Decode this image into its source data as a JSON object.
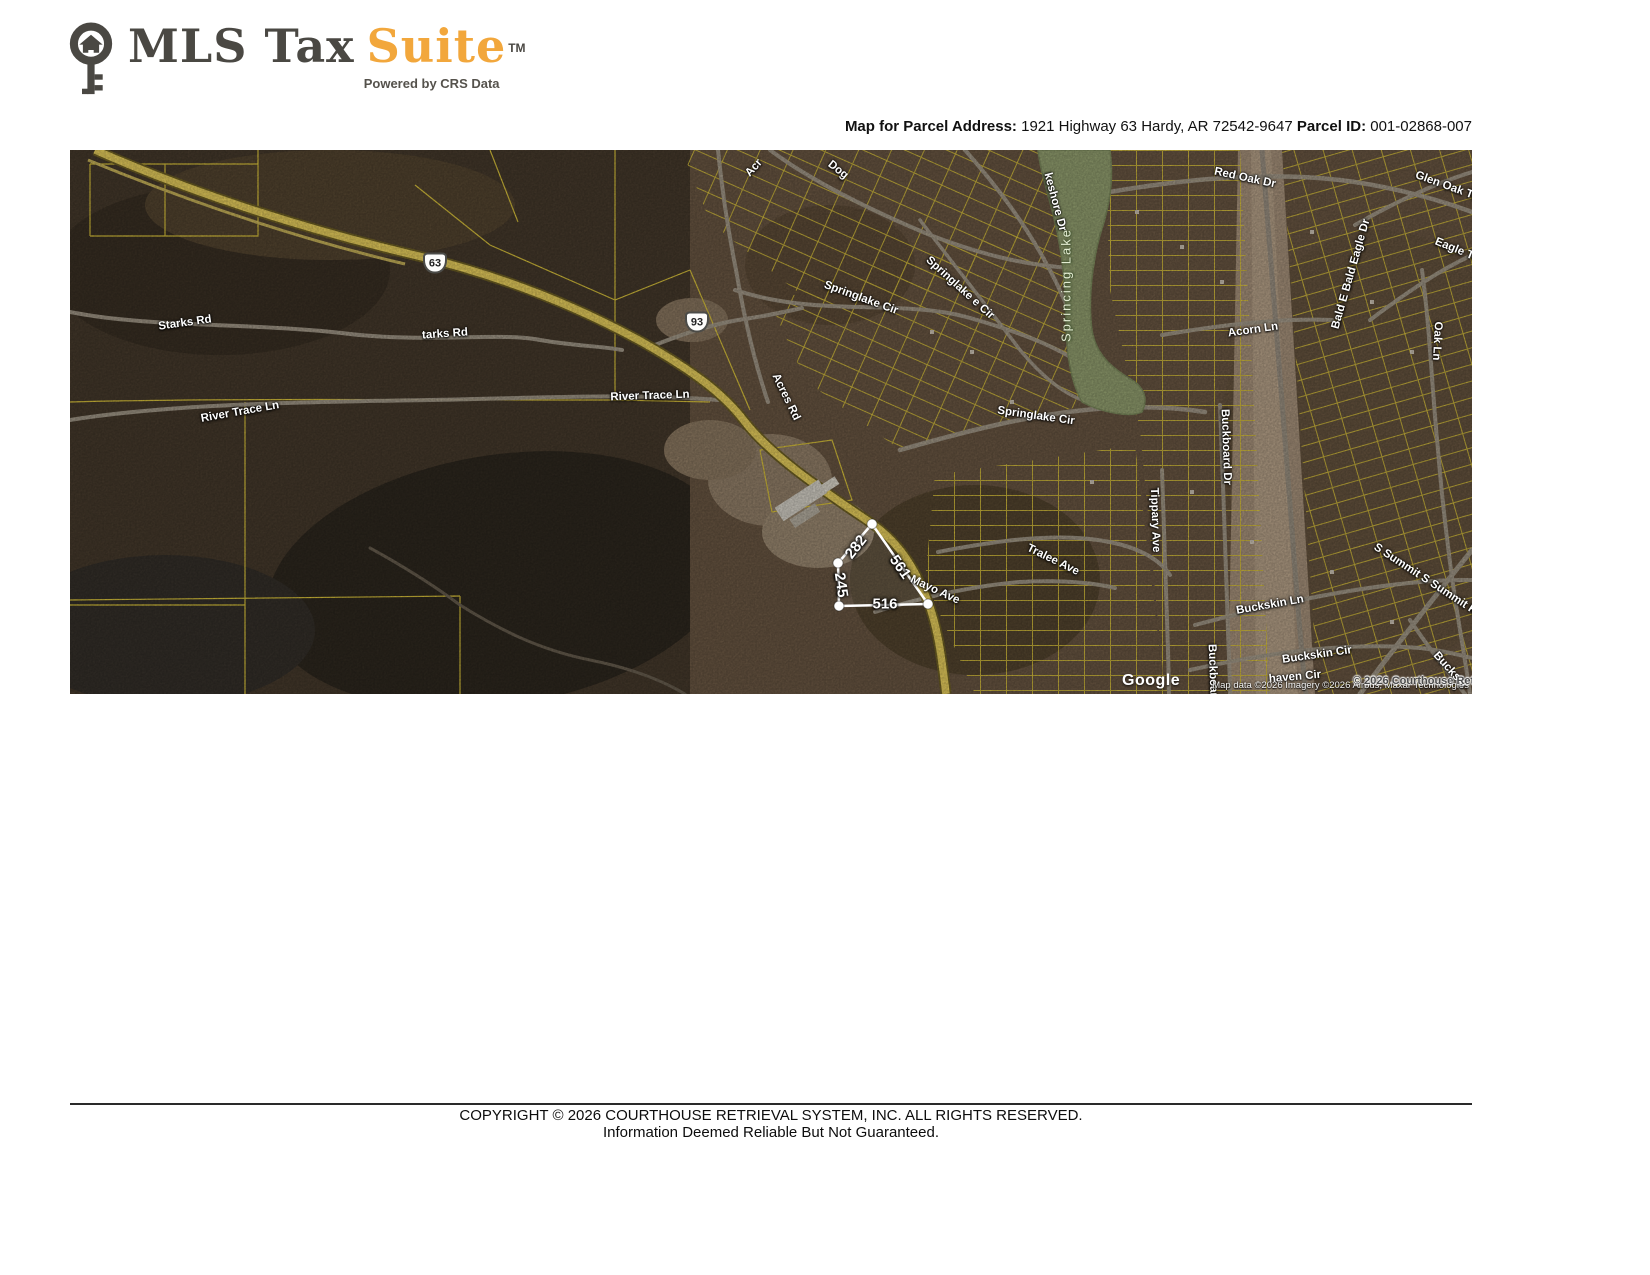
{
  "logo": {
    "brand_mls": "MLS Tax",
    "brand_suite": "Suite",
    "tm": "TM",
    "tagline": "Powered by CRS Data"
  },
  "header": {
    "address_label": "Map for Parcel Address:",
    "address_value": "1921 Highway 63 Hardy, AR 72542-9647",
    "parcel_label": "Parcel ID:",
    "parcel_value": "001-02868-007"
  },
  "map": {
    "shields": [
      {
        "route": "63"
      },
      {
        "route": "93"
      }
    ],
    "labels": [
      {
        "text": "Starks Rd"
      },
      {
        "text": "tarks Rd"
      },
      {
        "text": "River Trace Ln"
      },
      {
        "text": "River Trace Ln"
      },
      {
        "text": "Acr"
      },
      {
        "text": "Dog"
      },
      {
        "text": "Acres Rd"
      },
      {
        "text": "Springlake Cir"
      },
      {
        "text": "Springlake e Cir"
      },
      {
        "text": "keshore Dr"
      },
      {
        "text": "Sprincing Lake"
      },
      {
        "text": "Springlake Cir"
      },
      {
        "text": "Red Oak Dr"
      },
      {
        "text": "Glen Oak Trail"
      },
      {
        "text": "Eagle Trail"
      },
      {
        "text": "Acorn Ln"
      },
      {
        "text": "Bald E Bald Eagle Dr"
      },
      {
        "text": "Oak Ln"
      },
      {
        "text": "Tralee Ave"
      },
      {
        "text": "Tippary Ave"
      },
      {
        "text": "Buckboard Dr"
      },
      {
        "text": "Buckboard Dr"
      },
      {
        "text": "Buckskin Ln"
      },
      {
        "text": "Buckskin Cir"
      },
      {
        "text": "Buckski"
      },
      {
        "text": "S Summit S Summit Ridge Dr"
      },
      {
        "text": "Mayo Ave"
      },
      {
        "text": "haven Cir"
      }
    ],
    "dimensions": [
      {
        "text": "282"
      },
      {
        "text": "561"
      },
      {
        "text": "245"
      },
      {
        "text": "516"
      }
    ],
    "overlays": {
      "crs_copyright": "© 2026 Courthouse Retrieval System, Inc",
      "google_logo": "Google",
      "attribution": "Map data ©2026 Imagery ©2026 Airbus, Maxar Technologies"
    }
  },
  "footer": {
    "line1": "COPYRIGHT © 2026 COURTHOUSE RETRIEVAL SYSTEM, INC. ALL RIGHTS RESERVED.",
    "line2": "Information Deemed Reliable But Not Guaranteed."
  },
  "colors": {
    "brand_orange": "#F2A73C",
    "brand_gray": "#4A4843",
    "parcel_line_yellow": "#D9C23C",
    "highway_yellow": "#E8CF5D",
    "lake_green": "#93A070",
    "highlight_white": "#FFFFFF"
  }
}
